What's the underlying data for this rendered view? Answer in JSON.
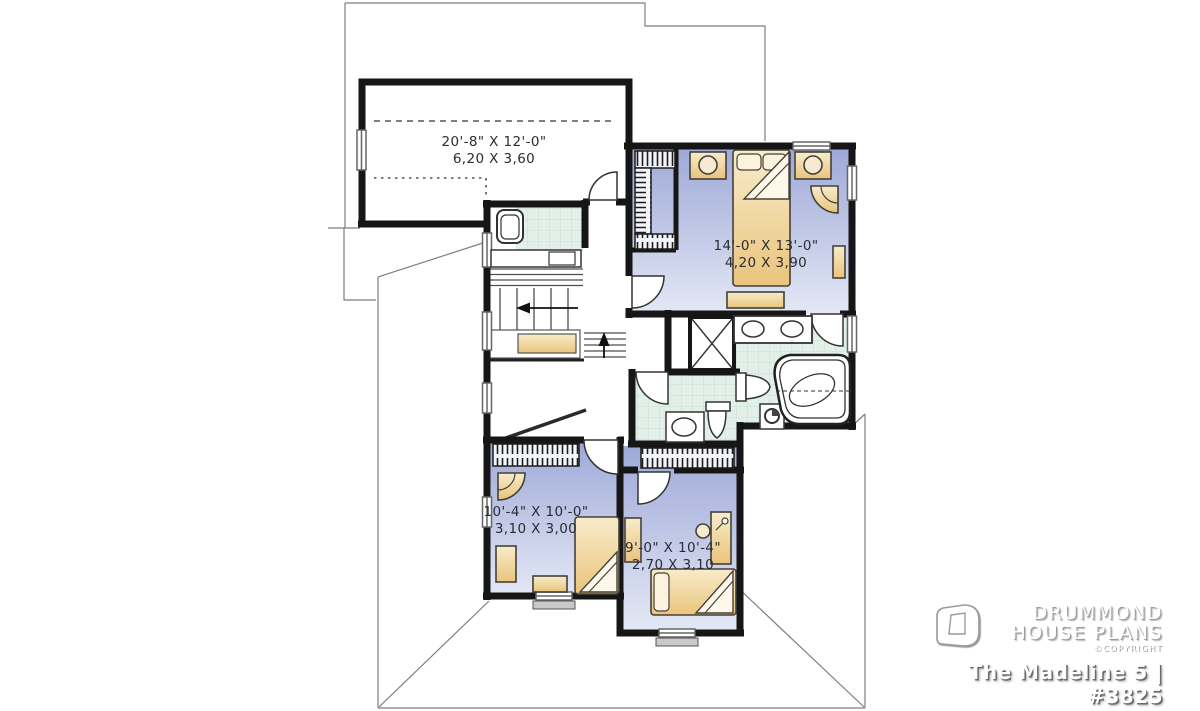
{
  "branding": {
    "name_line1": "DRUMMOND",
    "name_line2": "HOUSE PLANS",
    "copyright": "©COPYRIGHT",
    "plan_title": "The Madeline 5 | #3825"
  },
  "rooms": {
    "bonus": {
      "name": "bonus-room",
      "imperial": "20'-8\" X 12'-0\"",
      "metric": "6,20 X 3,60"
    },
    "master": {
      "name": "master-bedroom",
      "imperial": "14'-0\" X 13'-0\"",
      "metric": "4,20 X 3,90"
    },
    "bedroom2": {
      "name": "bedroom-2",
      "imperial": "10'-4\" X 10'-0\"",
      "metric": "3,10 X 3,00"
    },
    "bedroom3": {
      "name": "bedroom-3",
      "imperial": "9'-0\" X 10'-4\"",
      "metric": "2,70 X 3,10"
    }
  },
  "colors": {
    "wall": "#161616",
    "bedroom_floor_dark": "#9ea9d8",
    "bedroom_floor_light": "#e4e8f5",
    "bath_tile": "#e3f0e9",
    "bath_tile_grid": "#c6dfd2",
    "furniture_light": "#f8ecca",
    "furniture_dark": "#e9c47c",
    "roof_line": "#7e7e7e"
  }
}
